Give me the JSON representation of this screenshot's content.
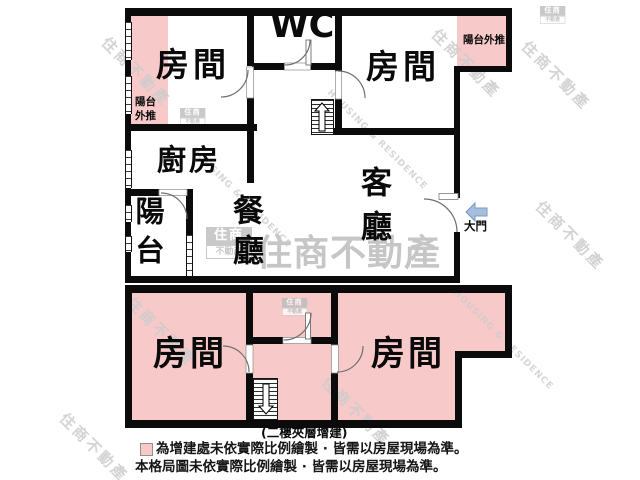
{
  "colors": {
    "addition_pink": "#f8c9c9",
    "wall_black": "#0b0b0b",
    "arrow_blue_fill": "#a6bede",
    "arrow_blue_border": "#7b97c2",
    "watermark_gray": "#cccccc"
  },
  "upper": {
    "bedroom_left": "房間",
    "wc": "WC",
    "bedroom_right": "房間",
    "kitchen": "廚房",
    "balcony": "陽台",
    "dining": "餐廳",
    "living": "客廳",
    "pushout_left": "陽台外推",
    "pushout_right": "陽台外推",
    "main_door": "大門"
  },
  "lower": {
    "bedroom_left": "房間",
    "bedroom_right": "房間",
    "caption": "(二樓夾層增建)"
  },
  "legend": {
    "line1": "為增建處未依實際比例繪製 · 皆需以房屋現場為準。",
    "line2": "本格局圖未依實際比例繪製 · 皆需以房屋現場為準。"
  },
  "watermark": {
    "brand": "住商不動產",
    "brand_en": "HOUSING & RESIDENCE",
    "logo_top": "住商",
    "logo_bottom": "不動產"
  }
}
